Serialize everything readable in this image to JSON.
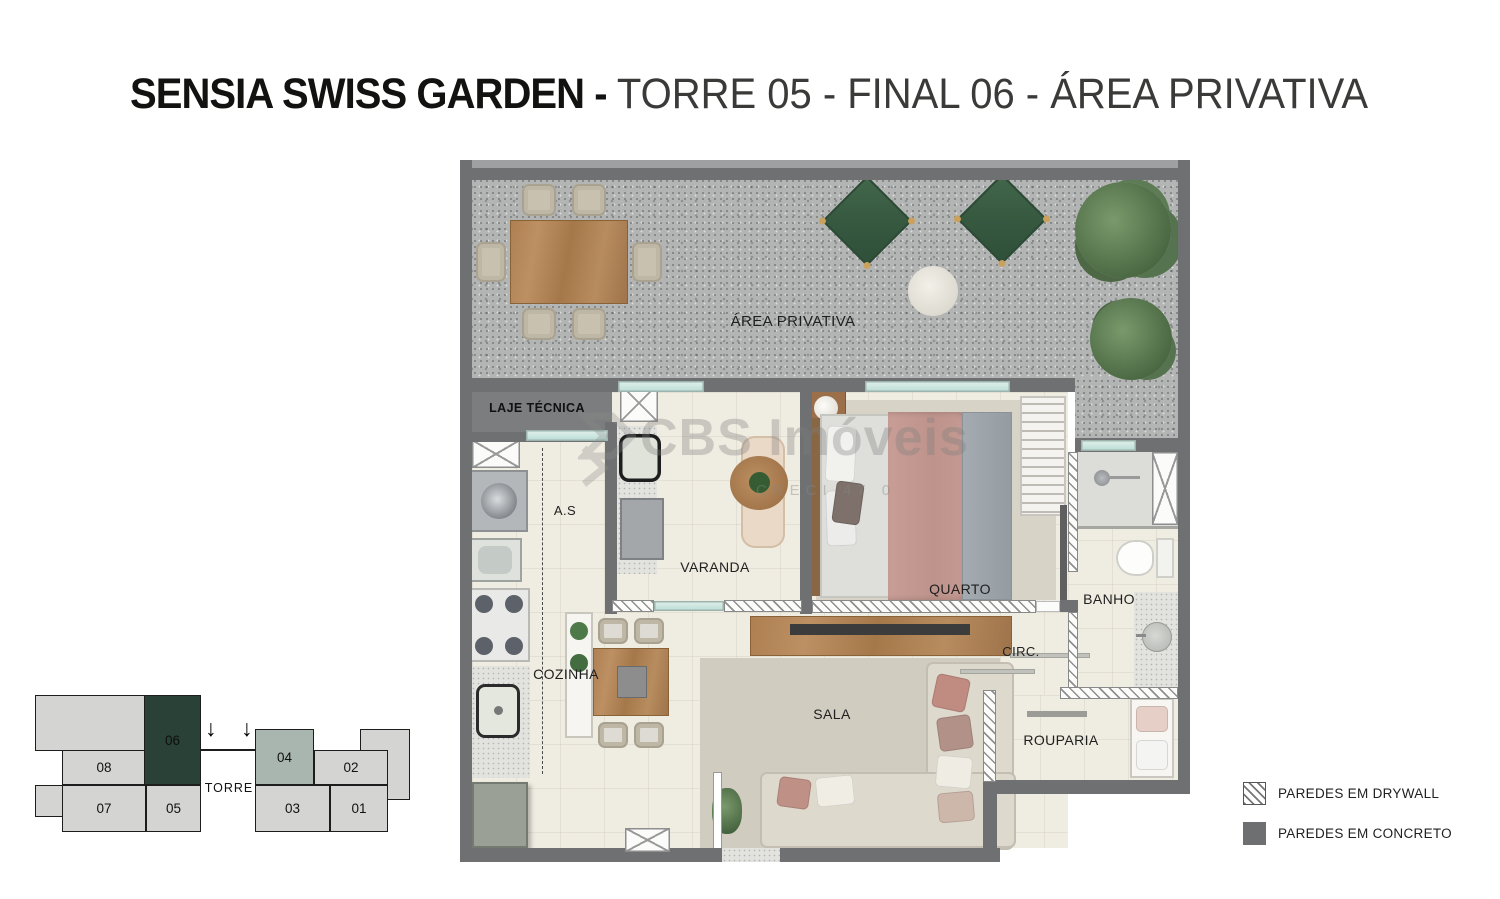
{
  "title": {
    "brand": "SENSIA SWISS GARDEN - ",
    "details": "TORRE 05 - FINAL 06 - ÁREA PRIVATIVA"
  },
  "plan": {
    "labels": {
      "area_privativa": "ÁREA PRIVATIVA",
      "laje_tecnica": "LAJE TÉCNICA",
      "as": "A.S",
      "varanda": "VARANDA",
      "quarto": "QUARTO",
      "banho": "BANHO",
      "cozinha": "COZINHA",
      "circ": "CIRC.",
      "sala": "SALA",
      "rouparia": "ROUPARIA"
    }
  },
  "watermark": {
    "brand": "CBS Imóveis",
    "creci": "CRECI 47 0"
  },
  "keyplan": {
    "torre": "TORRE",
    "arrow": "↓",
    "units": [
      {
        "label": "08",
        "variant": "default"
      },
      {
        "label": "06",
        "variant": "selected"
      },
      {
        "label": "04",
        "variant": "secondary"
      },
      {
        "label": "02",
        "variant": "default"
      },
      {
        "label": "07",
        "variant": "default"
      },
      {
        "label": "05",
        "variant": "default"
      },
      {
        "label": "03",
        "variant": "default"
      },
      {
        "label": "01",
        "variant": "default"
      }
    ]
  },
  "legend": {
    "drywall": "PAREDES EM DRYWALL",
    "concrete": "PAREDES EM CONCRETO"
  },
  "colors": {
    "selected_unit": "#2a4138",
    "secondary_unit": "#a9b6af",
    "wall": "#6e7072",
    "terrace_floor": "#b3b5b4",
    "interior_floor": "#efece1",
    "accent_wood": "#ad7f51",
    "lounger_green": "#375a41"
  }
}
